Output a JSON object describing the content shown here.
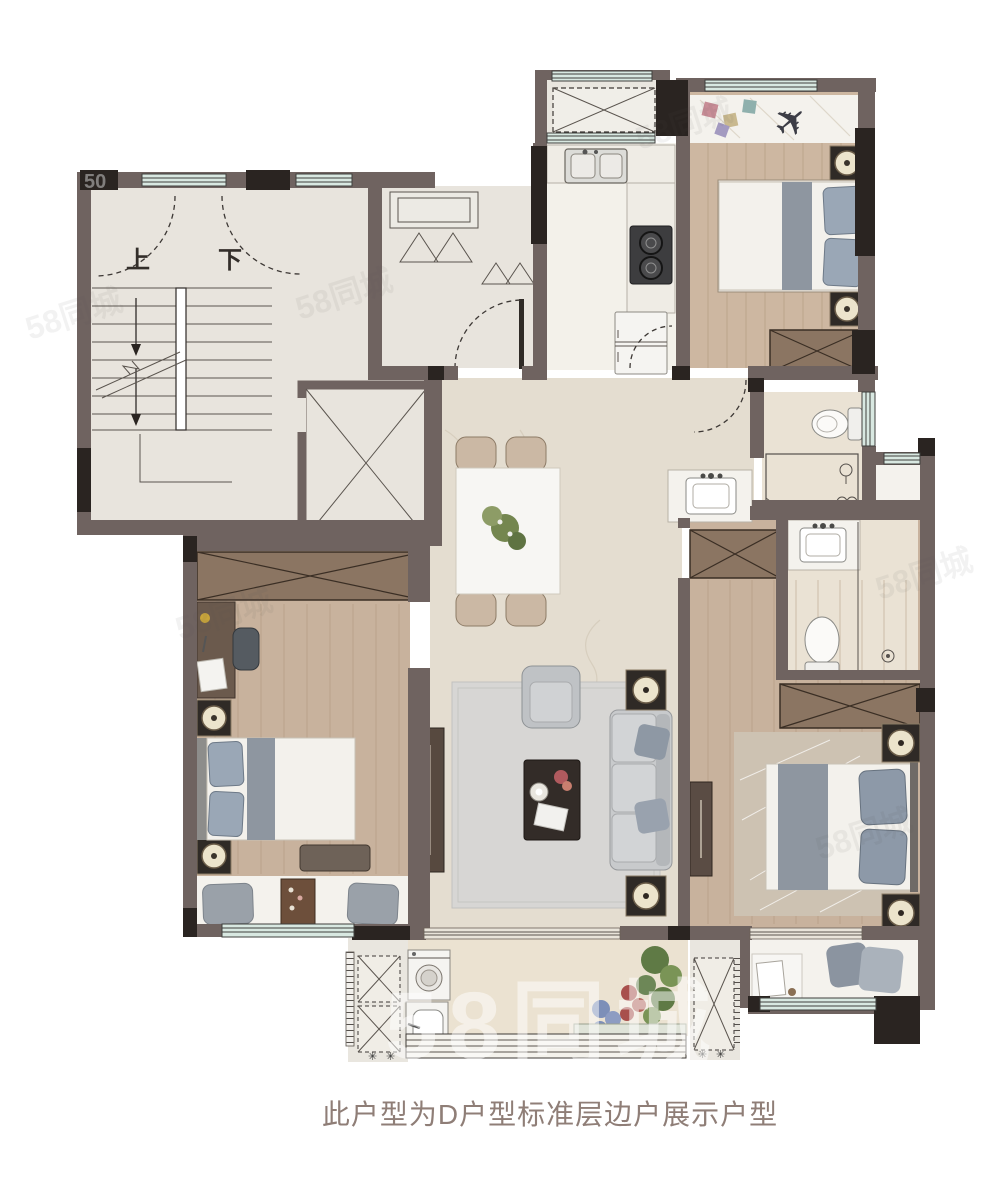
{
  "title_caption": "此户型为D户型标准层边户展示户型",
  "stairs": {
    "up": "上",
    "down": "下"
  },
  "watermark": {
    "brand": "58同城",
    "corner": "50"
  },
  "icons": {
    "plane": "✈",
    "fan": "✳"
  },
  "colors": {
    "wall": "#6f6360",
    "column": "#2a2421",
    "window_glass": "#d8e8e1",
    "marble_floor": "#e4ddd0",
    "wood_floor": "#cdb7a1",
    "lobby_floor": "#e8e4dd",
    "bath_floor": "#eae2d4",
    "white_marble": "#f4f2ed",
    "wardrobe_wood": "#8b7562",
    "caption_text": "#8f7e77"
  }
}
